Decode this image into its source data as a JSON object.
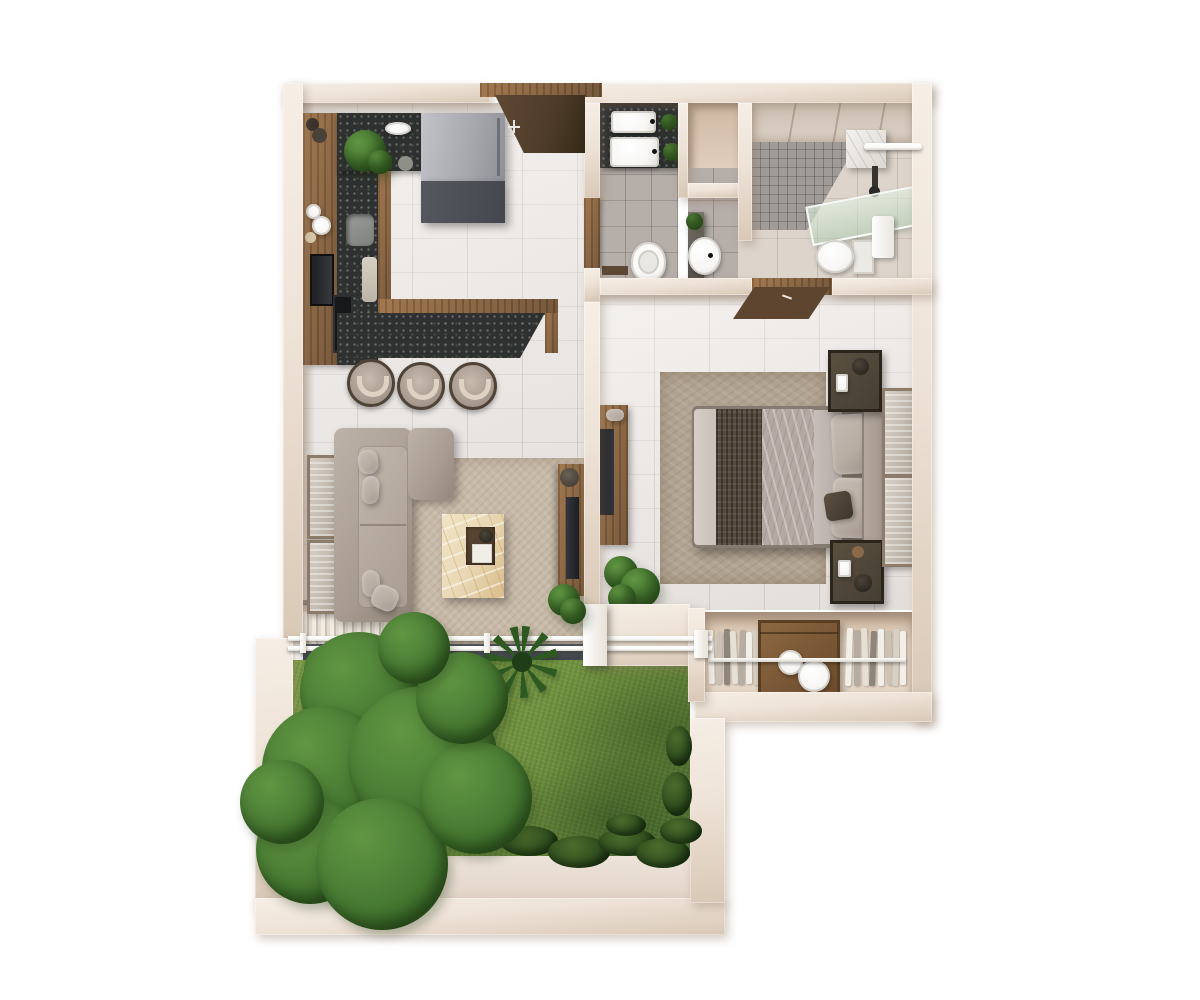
{
  "scene": {
    "type": "3d-floor-plan",
    "view": "top-down-render",
    "description": "One-bedroom apartment 3D floor plan, top view, with kitchen, living room, bedroom, two bath areas, wardrobe, louvered deck and private garden",
    "background": "#ffffff"
  },
  "palette": {
    "wall": "#eee3d7",
    "wall_shade": "#d9c8b6",
    "floor_tile": "#eae5e1",
    "gray_tile": "#b6aea9",
    "bath_floor": "#ddd4cb",
    "mosaic": "#a19b97",
    "counter_dark": "#2e3130",
    "wood": "#9b7046",
    "wood_dark": "#6e4f31",
    "door": "#4e3c29",
    "fridge": "#a8a9af",
    "fridge_base": "#44474d",
    "sofa": "#a89c92",
    "cushion": "#b9aea4",
    "rug_living": "#c7b9a7",
    "rug_bedroom": "#b2a492",
    "marble": "#e9d8b5",
    "tray": "#463627",
    "bed_throw": "#564a3f",
    "bed_duvet": "#b4a8a3",
    "bed_sheet": "#cac0ba",
    "headboard": "#a3978e",
    "nightstand": "#463e33",
    "grass": "#70923f",
    "grass_dark": "#4c6e2e",
    "tree": "#447630",
    "tree_light": "#619643",
    "hedge": "#32501f",
    "deck_light": "#f2ece3",
    "deck_shade": "#c9bfb2",
    "pergola": "#3b4046",
    "rail": "#fafaf8",
    "glass": "#c9ddcb",
    "porcelain": "#f7f6f4",
    "plant": "#3e7a2d"
  },
  "rooms": [
    {
      "id": "kitchen",
      "label": "Kitchen",
      "items": [
        "tall-wood-cabinet-run",
        "l-shaped-granite-counter",
        "undermount-sink",
        "cutting-board",
        "cooktop",
        "built-in-oven",
        "refrigerator",
        "breakfast-bar",
        "bar-stools-x3",
        "potted-plant",
        "wall-plates-decor"
      ]
    },
    {
      "id": "entry",
      "label": "Entry",
      "items": [
        "entry-door-open",
        "wood-lintel"
      ]
    },
    {
      "id": "living-room",
      "label": "Living room",
      "items": [
        "l-shaped-sofa",
        "throw-pillows-x4",
        "area-rug",
        "marble-coffee-table",
        "serving-tray",
        "tv-console",
        "tv",
        "wall-art-x2",
        "floor-speaker"
      ]
    },
    {
      "id": "guest-bathroom",
      "label": "Guest bathroom",
      "items": [
        "double-sink-vanity",
        "mirror-strip",
        "plants",
        "toilet",
        "bath-mat",
        "wood-door"
      ]
    },
    {
      "id": "storage-niche",
      "label": "Storage niche",
      "items": [
        "recessed-shelf"
      ]
    },
    {
      "id": "powder-corner",
      "label": "Powder corner",
      "items": [
        "round-washbasin",
        "stone-counter",
        "plant"
      ]
    },
    {
      "id": "main-bathroom",
      "label": "Main bathroom",
      "items": [
        "mosaic-shower-floor",
        "marble-shelf",
        "towel-bar",
        "hand-shower",
        "glass-screen",
        "toilet",
        "towel"
      ]
    },
    {
      "id": "bedroom",
      "label": "Bedroom",
      "items": [
        "double-bed",
        "dark-knit-throw",
        "patterned-duvet",
        "pillows-x2",
        "accent-cushion",
        "headboard",
        "nightstand-x2",
        "wall-art-x2",
        "tv-console",
        "tv",
        "area-rug",
        "plants",
        "wood-door-open"
      ]
    },
    {
      "id": "wardrobe",
      "label": "Wardrobe",
      "items": [
        "hanging-clothes-left",
        "wood-dresser",
        "round-boxes-x2",
        "hanging-clothes-right",
        "clothes-rail"
      ]
    },
    {
      "id": "deck",
      "label": "Louvered deck",
      "items": [
        "slatted-louvers",
        "double-white-railing",
        "railing-posts",
        "white-pillar",
        "dark-fascia",
        "shrubs"
      ]
    },
    {
      "id": "garden",
      "label": "Garden",
      "items": [
        "lawn",
        "large-tree",
        "palm-plant",
        "shrub",
        "hedge-row",
        "patio-strip",
        "perimeter-walls"
      ]
    }
  ],
  "wardrobe_detail": {
    "left_hangers": 7,
    "right_hangers": 8,
    "round_boxes": 2
  },
  "bar_stool_count": 3
}
